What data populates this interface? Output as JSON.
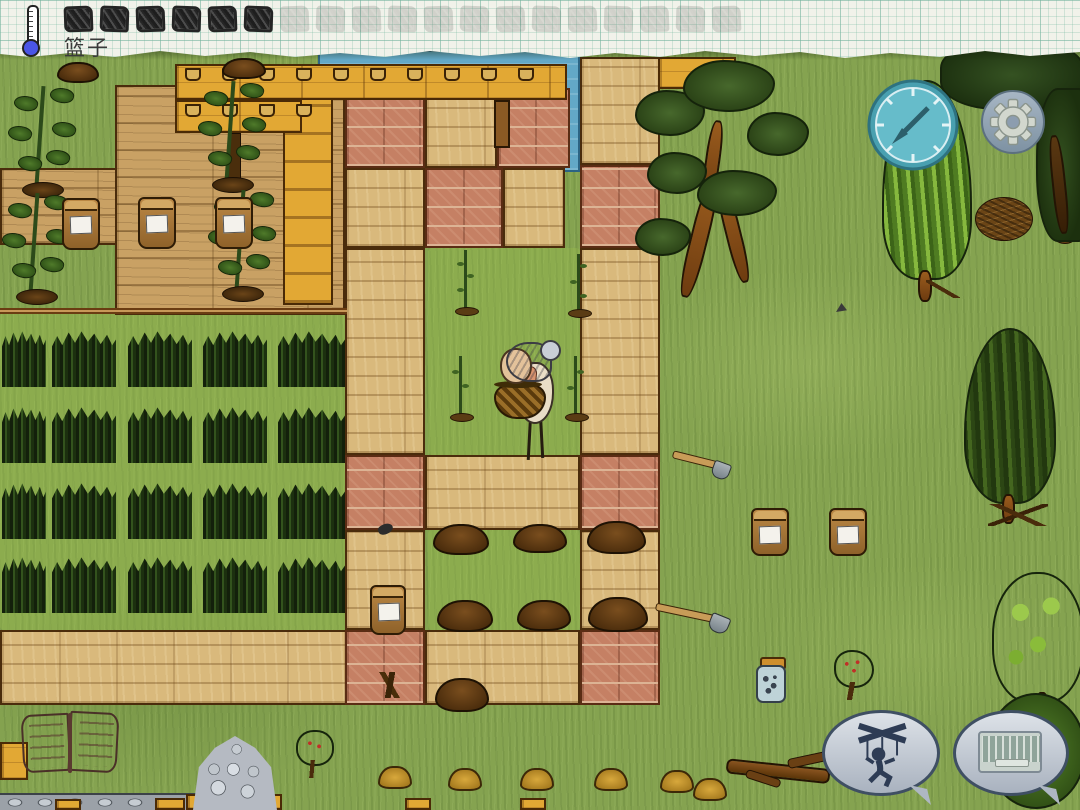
{
  "hud": {
    "selected_item_label": "篮子",
    "food_pips": {
      "filled": 6,
      "empty": 13
    },
    "thermometer": {
      "icon": "thermometer-icon",
      "bulb_color": "#4a55e6"
    },
    "paper_color": "#f1f2ea"
  },
  "controls": {
    "compass": {
      "icon": "compass-icon",
      "color": "#57b1c0"
    },
    "settings": {
      "icon": "gear-icon",
      "color": "#93a5b3"
    },
    "emote": {
      "icon": "puppet-crossed-icon"
    },
    "chat": {
      "icon": "keyboard-icon"
    }
  },
  "scene": {
    "crop_field": {
      "rows": 4,
      "cols": 5
    },
    "cup_shelf": {
      "top_row_cups": 10,
      "bottom_row_cups": 4
    },
    "sapling_count": 4,
    "yellow_mound_count": 6,
    "items": [
      "old-woman-with-basket",
      "tree-sapling",
      "soil-pile",
      "labeled-crock",
      "soil-crock",
      "seed-jar",
      "shovel",
      "berry-seedling",
      "stone-pile",
      "open-book",
      "fallen-branch",
      "kindling-pile",
      "tomato-plant",
      "crop-row",
      "water-pond",
      "wood-bridge",
      "cup-shelf"
    ]
  },
  "palette": {
    "grass": "#85a350",
    "adobe": "#d9b97c",
    "brick": "#c58064",
    "wood": "#c9a164",
    "plank_yellow": "#e2a834",
    "water": "#63a8c7"
  }
}
